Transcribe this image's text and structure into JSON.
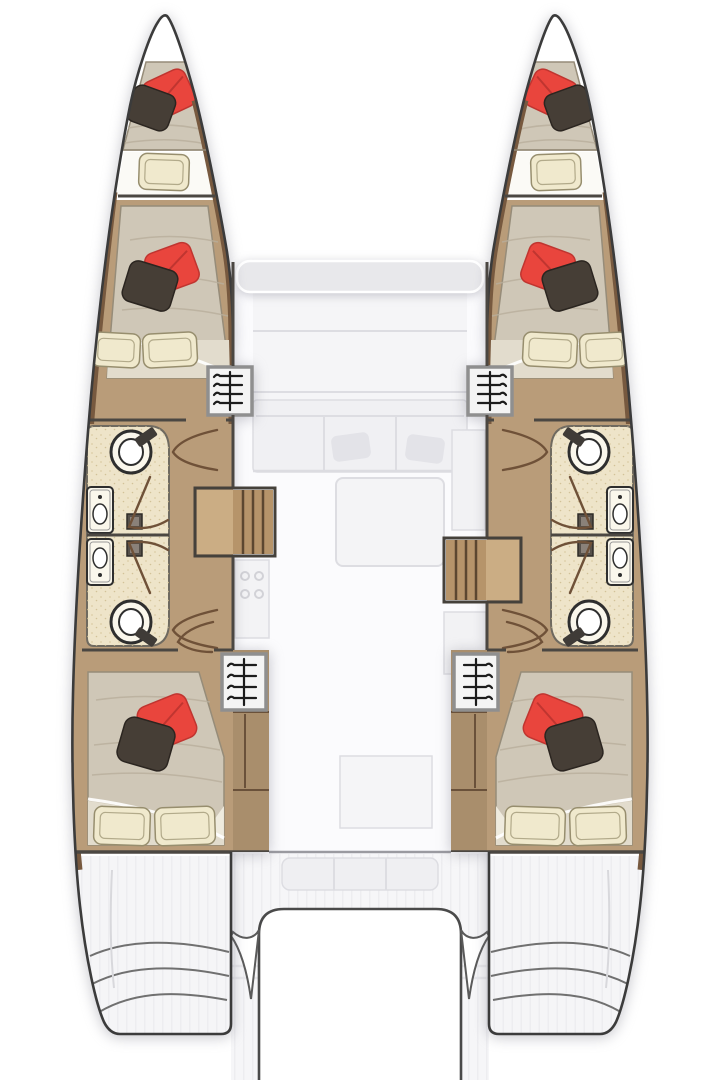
{
  "page": {
    "title": "Catamaran 4-cabin / 4-head layout floor plan (top view)",
    "text_visible": "none"
  },
  "colors": {
    "background": "#ffffff",
    "hull_fill": "#ffffff",
    "hull_outline": "#3b3b3b",
    "wall": "#4b4742",
    "wood_floor": "#b99c79",
    "wood_trim": "#77593f",
    "wood_cabinet": "#a98e6c",
    "wood_stairs": "#b6946a",
    "wood_stairs_light": "#cbad84",
    "stair_tread": "#5c4730",
    "mattress": "#cfc7b7",
    "mattress_edge": "#968c79",
    "mattress_texture": "#b8ae9b",
    "mattress_fold": "#e2dccd",
    "pillow_cream": "#f0e9cd",
    "pillow_cream_edge": "#978e6e",
    "pillow_red": "#e9453d",
    "pillow_red_shade": "#c03530",
    "pillow_dark": "#463e36",
    "pillow_dark_edge": "#2b2520",
    "bathroom_floor": "#eee4c9",
    "bathroom_speckle": "#d5c59b",
    "bath_edge": "#6f6a60",
    "fixture_line": "#2e2e2e",
    "fixture_fill": "#faf7ec",
    "locker_fill": "#f4f4f4",
    "locker_frame": "#8f8f8f",
    "hanger": "#1c1c1c",
    "door_line": "#6f5138",
    "ghost_fill": "#f0f0f3",
    "ghost_edge": "#dddde2",
    "saloon_floor": "#fbfbfd",
    "stripe": "#ebebee",
    "stern_fill": "#f5f5f7",
    "step_line": "#707070",
    "cutout_line": "#4a4a4a",
    "front_band": "#e8e8eb"
  },
  "vessel": {
    "type": "sailing catamaran interior layout, plan view, bows at top",
    "counts": {
      "hulls": 2,
      "double_cabins": 4,
      "heads": 4,
      "bow_berths": 2,
      "hanging_lockers": 4,
      "companionway_stairs": 2
    },
    "port_hull": {
      "label": "Port hull (left)",
      "rooms": [
        {
          "id": "port-bow-berth",
          "label": "Bow peak berth",
          "pillows": [
            "red",
            "dark-brown"
          ]
        },
        {
          "id": "port-forward-berth",
          "label": "Forward berth cushion",
          "pillows": [
            "cream"
          ]
        },
        {
          "id": "port-forward-cabin",
          "label": "Forward double cabin",
          "pillows": [
            "red",
            "dark-brown",
            "cream",
            "cream"
          ]
        },
        {
          "id": "port-forward-head",
          "label": "Forward head: WC, basin, shower control, door"
        },
        {
          "id": "port-aft-head",
          "label": "Aft head: WC, basin, shower control, door"
        },
        {
          "id": "port-aft-cabin",
          "label": "Aft double cabin",
          "pillows": [
            "red",
            "dark-brown",
            "cream",
            "cream"
          ]
        },
        {
          "id": "port-transom",
          "label": "Transom steps / sugar scoop"
        }
      ],
      "fixtures": [
        "hanging locker forward",
        "hanging locker aft",
        "companionway stairs to saloon"
      ]
    },
    "starboard_hull": {
      "label": "Starboard hull (right, mirror of port)",
      "rooms": [
        {
          "id": "stbd-bow-berth",
          "label": "Bow peak berth",
          "pillows": [
            "red",
            "dark-brown"
          ]
        },
        {
          "id": "stbd-forward-berth",
          "label": "Forward berth cushion",
          "pillows": [
            "cream"
          ]
        },
        {
          "id": "stbd-forward-cabin",
          "label": "Forward double cabin",
          "pillows": [
            "red",
            "dark-brown",
            "cream",
            "cream"
          ]
        },
        {
          "id": "stbd-forward-head",
          "label": "Forward head: WC, basin, shower control, door"
        },
        {
          "id": "stbd-aft-head",
          "label": "Aft head: WC, basin, shower control, door"
        },
        {
          "id": "stbd-aft-cabin",
          "label": "Aft double cabin",
          "pillows": [
            "red",
            "dark-brown",
            "cream",
            "cream"
          ]
        },
        {
          "id": "stbd-transom",
          "label": "Transom steps / sugar scoop"
        }
      ],
      "fixtures": [
        "hanging locker forward",
        "hanging locker aft",
        "companionway stairs to saloon"
      ]
    },
    "bridge_deck": {
      "label": "Bridge deck (ghosted / faded)",
      "areas": [
        "coachroof front window band",
        "saloon sofa with two cushions",
        "dining table",
        "galley cooktop with four burners",
        "galley side units",
        "cockpit bench",
        "transom platform cutout",
        "two davit fins"
      ]
    }
  }
}
